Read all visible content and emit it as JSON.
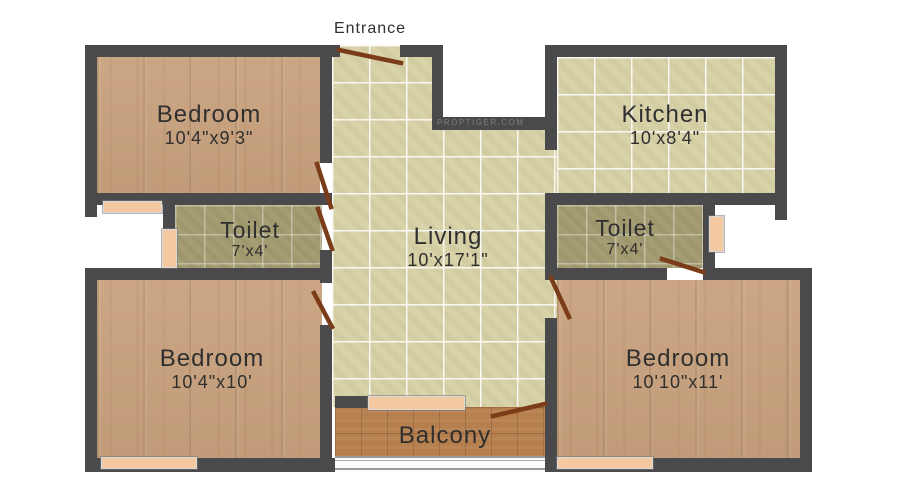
{
  "entrance_label": "Entrance",
  "watermark": "proptiger.com",
  "rooms": {
    "bedroom_top_left": {
      "name": "Bedroom",
      "dims": "10'4\"x9'3\""
    },
    "kitchen": {
      "name": "Kitchen",
      "dims": "10'x8'4\""
    },
    "toilet_left": {
      "name": "Toilet",
      "dims": "7'x4'"
    },
    "living": {
      "name": "Living",
      "dims": "10'x17'1\""
    },
    "toilet_right": {
      "name": "Toilet",
      "dims": "7'x4'"
    },
    "bedroom_bottom_left": {
      "name": "Bedroom",
      "dims": "10'4\"x10'"
    },
    "bedroom_bottom_right": {
      "name": "Bedroom",
      "dims": "10'10\"x11'"
    },
    "balcony": {
      "name": "Balcony",
      "dims": ""
    }
  },
  "colors": {
    "bg": "#ffffff",
    "wall": "#4a4a4c",
    "wood": "#c9a27e",
    "tile": "#d8d2a9",
    "olive": "#a49c72",
    "terracotta": "#b67f4e",
    "window": "#f4c8a1",
    "door": "#7b3d19",
    "text": "#2f2f2f"
  }
}
